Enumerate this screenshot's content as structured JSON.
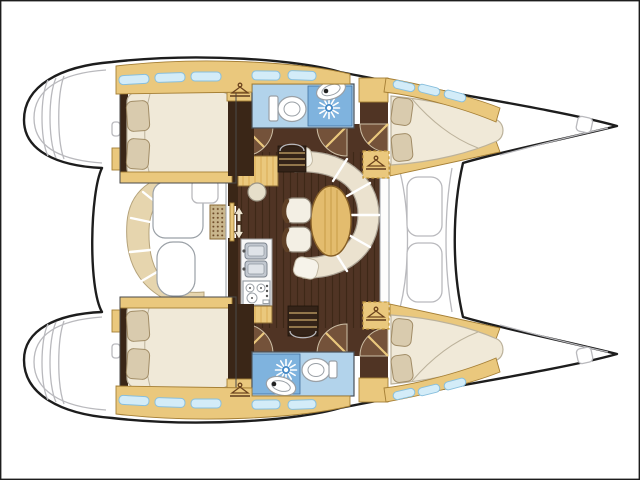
{
  "meta": {
    "diagram_type": "boat-floor-plan",
    "vessel": "sailing-catamaran",
    "view": "top-down-interior-layout",
    "orientation": "bows-right"
  },
  "rooms": {
    "port_transom": "port-transom-steps",
    "stbd_transom": "starboard-transom-steps",
    "cockpit": "aft-cockpit-seating",
    "saloon": "saloon-dinette",
    "galley": "galley",
    "chart_table": "chart-table",
    "port_aft_cabin": "port-aft-double-cabin",
    "port_head": "port-head-with-shower",
    "port_fwd_cabin": "port-forward-double-cabin",
    "stbd_aft_cabin": "starboard-aft-double-cabin",
    "stbd_head": "starboard-head-with-shower",
    "stbd_fwd_cabin": "starboard-forward-double-cabin",
    "foredeck": "foredeck-between-bows"
  },
  "icons": {
    "hanger": "wardrobe-hanger-icon",
    "shower": "shower-rose-icon",
    "toilet": "toilet-icon",
    "basin": "washbasin-icon",
    "sink": "double-sink-icon",
    "stove": "stove-burners-icon",
    "steps": "companionway-steps-icon",
    "arrows": "entry-arrows-icon",
    "mat": "entry-mat",
    "window": "hull-window"
  },
  "colors": {
    "page_bg": "#ffffff",
    "outline": "#1d1d1d",
    "deck_line": "#b9b9bd",
    "wood_light": "#eac87d",
    "wood_light_edge": "#a57f35",
    "wood_grain": "#d9ab55",
    "floor_dark": "#503424",
    "floor_dark_grain": "#3e2817",
    "wall_dark": "#3a2617",
    "door_fan": "#74523a",
    "steps": "#342318",
    "mattress": "#f0e9d8",
    "mattress_edge": "#bcb29b",
    "pillow": "#d9cbae",
    "pillow_edge": "#a18c66",
    "settee": "#ebe2cf",
    "cockpit_seat": "#e6d5ae",
    "head_floor": "#b2d3eb",
    "head_floor_edge": "#41709f",
    "shower_tile": "#7fb3de",
    "shower_disc": "#4489c6",
    "window": "#d3ecf8",
    "window_edge": "#88bfdd",
    "table_wood": "#e3bc6e",
    "table_edge": "#876027",
    "counter": "#f7f7f7",
    "fixture_edge": "#9aa0a6",
    "sink_steel": "#c2c8d0",
    "mat": "#c9b68c",
    "mat_dot": "#6d4a27",
    "wardrobe_dash": "#c39a42"
  }
}
